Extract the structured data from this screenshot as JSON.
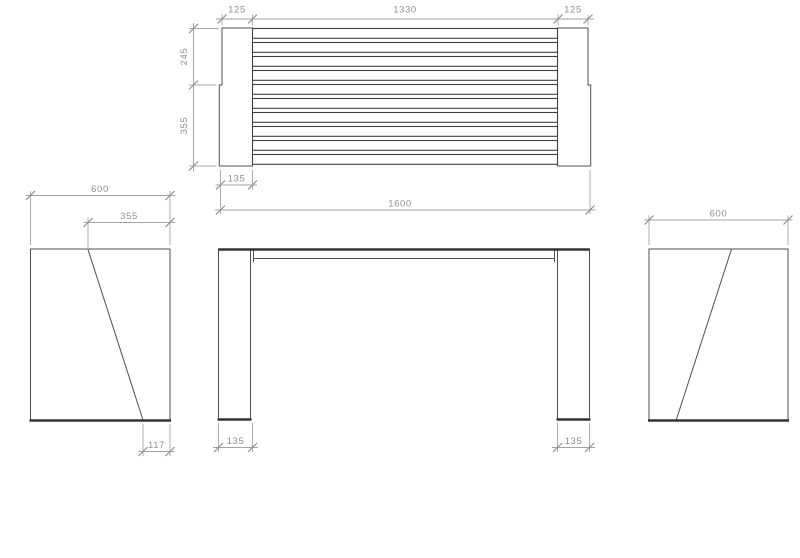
{
  "drawing": {
    "plan_view": {
      "dim_left_end": "125",
      "dim_slat_span": "1330",
      "dim_right_end": "125",
      "dim_front_depth": "245",
      "dim_back_depth": "355",
      "dim_end_width": "135",
      "dim_overall_length": "1600",
      "slat_count": 10
    },
    "front_view": {
      "dim_left_leg_width": "135",
      "dim_right_leg_width": "135"
    },
    "left_side_view": {
      "dim_overall_depth": "600",
      "dim_slope_top_offset": "355",
      "dim_slope_bottom_offset": "117"
    },
    "right_side_view": {
      "dim_overall_depth": "600"
    },
    "colors": {
      "background": "#ffffff",
      "object_line": "#4f4f4f",
      "thick_line": "#333333",
      "dimension_line": "#a3a3a3",
      "dimension_text": "#8f8f8f"
    }
  }
}
